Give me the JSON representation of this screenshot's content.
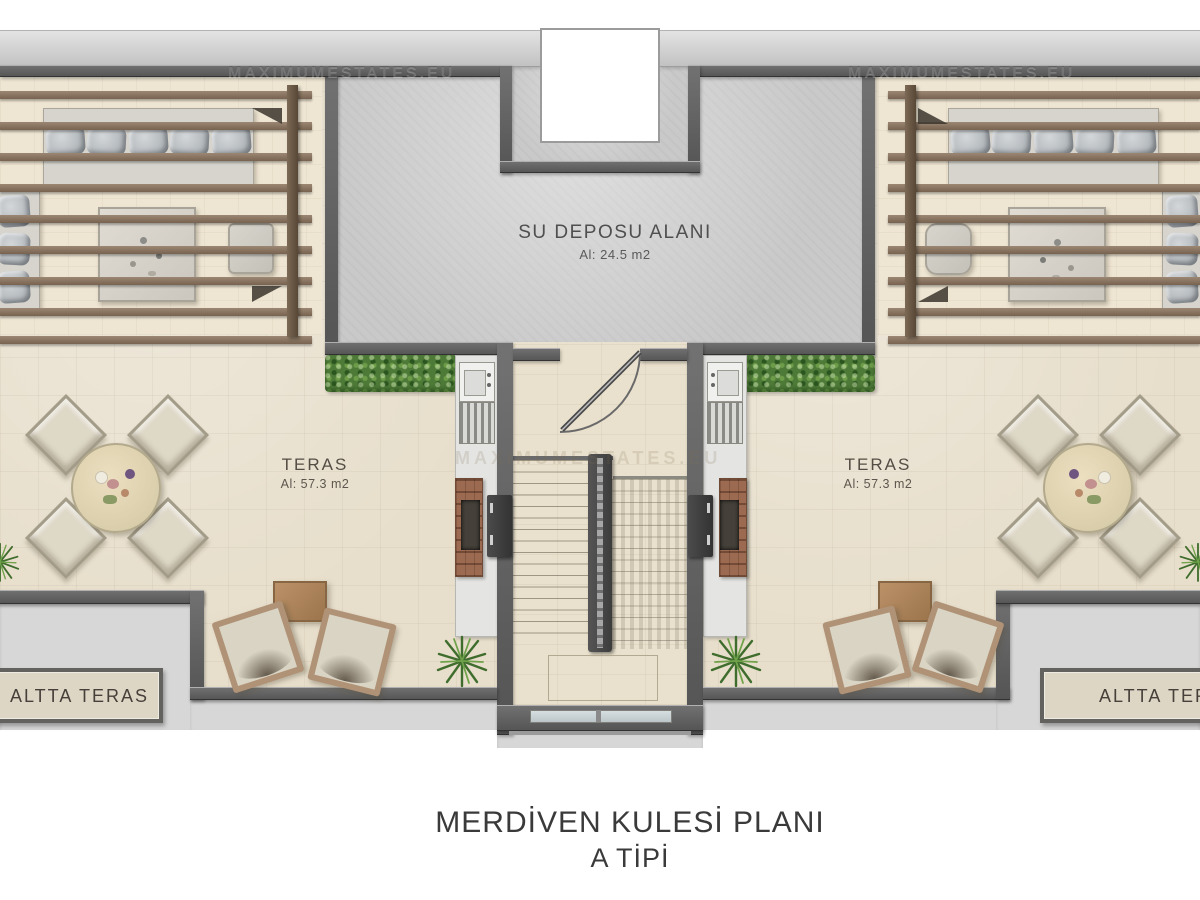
{
  "plan": {
    "watermarks": {
      "top_left": "MAXIMUMESTATES.EU",
      "top_right": "MAXIMUMESTATES.EU",
      "center": "MAXIMUMESTATES.EU"
    },
    "water_tank": {
      "label": "SU DEPOSU ALANI",
      "area": "Al: 24.5 m2"
    },
    "terrace_left": {
      "label": "TERAS",
      "area": "Al: 57.3 m2"
    },
    "terrace_right": {
      "label": "TERAS",
      "area": "Al: 57.3 m2"
    },
    "lower_terrace_left": {
      "label": "ALTTA TERAS"
    },
    "lower_terrace_right": {
      "label": "ALTTA TERAS"
    },
    "title": {
      "line1": "MERDİVEN KULESİ PLANI",
      "line2": "A TİPİ"
    },
    "colors": {
      "wall": "#5f5f5f",
      "concrete": "#c9c9c9",
      "terrace": "#e7decb",
      "pergola_deck": "#eee5d2",
      "slat": "#86715d",
      "hedge": "#4e7a38",
      "brick": "#9b6a50",
      "title_text": "#3a3a3a"
    }
  }
}
